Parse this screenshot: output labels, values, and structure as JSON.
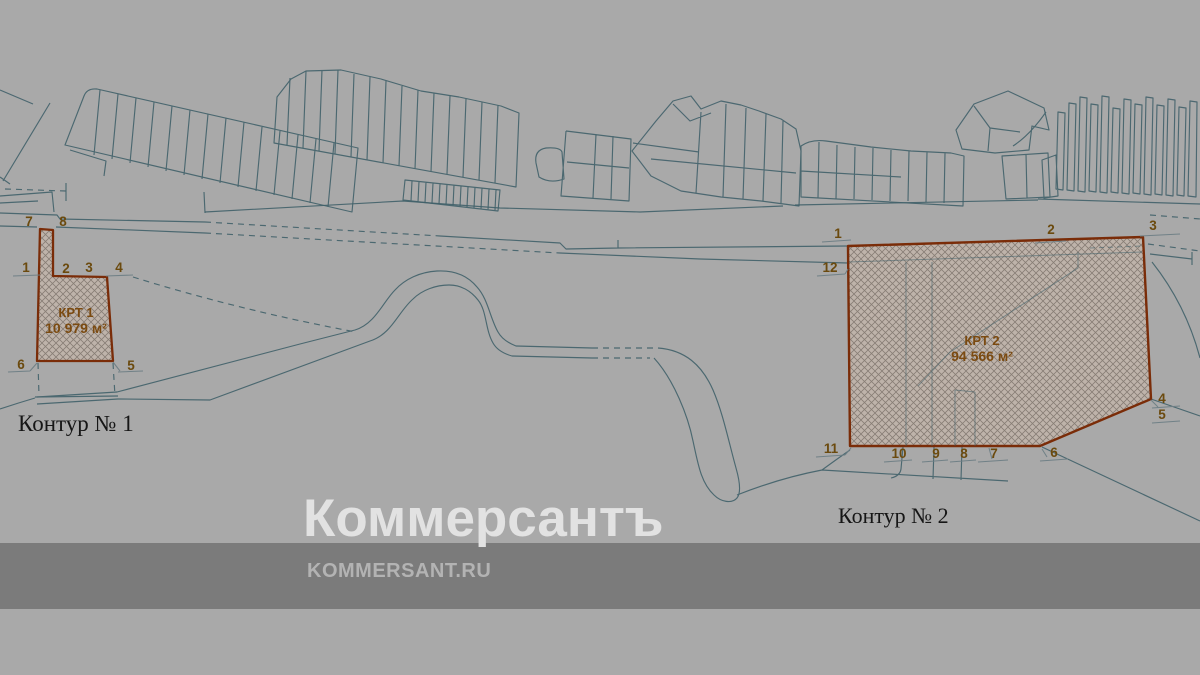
{
  "colors": {
    "background": "#a9a9a9",
    "band": "#7b7b7b",
    "parcel_line": "#41616a",
    "leader_line": "#6e7e85",
    "contour_outline": "#7a2c08",
    "hatch_fill": "#beb3aa",
    "hatch_line": "#6a6058",
    "number_text": "#6b4a0e",
    "krt_text": "#7b4a10"
  },
  "contour1": {
    "caption": "Контур № 1",
    "area_title": "КРТ 1",
    "area_value": "10 979 м²",
    "vertex_labels": {
      "v1": "1",
      "v2": "2",
      "v3": "3",
      "v4": "4",
      "v5": "5",
      "v6": "6",
      "v7": "7",
      "v8": "8"
    }
  },
  "contour2": {
    "caption": "Контур № 2",
    "area_title": "КРТ 2",
    "area_value": "94 566 м²",
    "vertex_labels": {
      "v1": "1",
      "v2": "2",
      "v3": "3",
      "v4": "4",
      "v5": "5",
      "v6": "6",
      "v7": "7",
      "v8": "8",
      "v9": "9",
      "v10": "10",
      "v11": "11",
      "v12": "12"
    }
  },
  "watermark": {
    "brand": "Коммерсантъ",
    "site": "KOMMERSANT.RU"
  }
}
